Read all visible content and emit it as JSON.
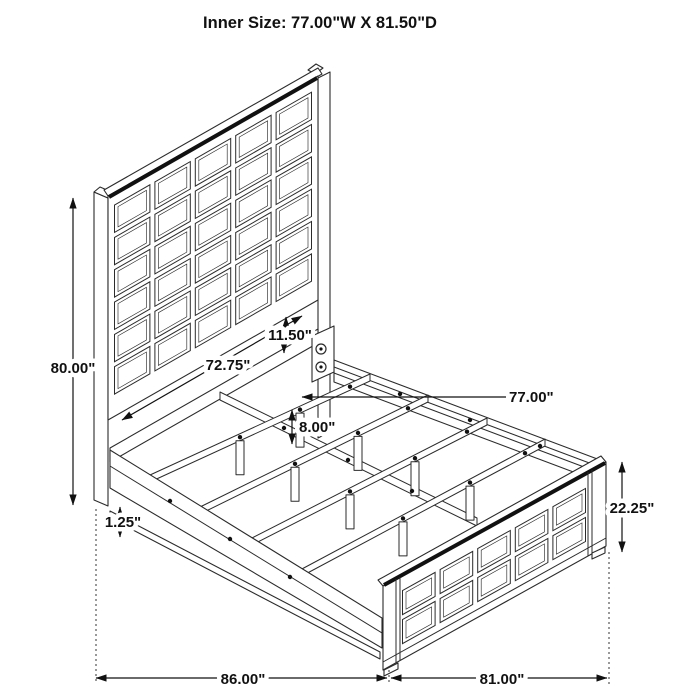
{
  "title": "Inner Size: 77.00\"W X 81.50\"D",
  "dimensions": {
    "headboard_height": "80.00\"",
    "headboard_width": "72.75\"",
    "headboard_panel_to_rail": "11.50\"",
    "inner_width": "77.00\"",
    "slat_leg_height": "8.00\"",
    "side_rail_lip": "1.25\"",
    "footboard_height": "22.25\"",
    "overall_depth": "86.00\"",
    "overall_width": "81.00\""
  },
  "colors": {
    "line": "#2b2b2b",
    "accent": "#111111",
    "background": "#ffffff"
  }
}
